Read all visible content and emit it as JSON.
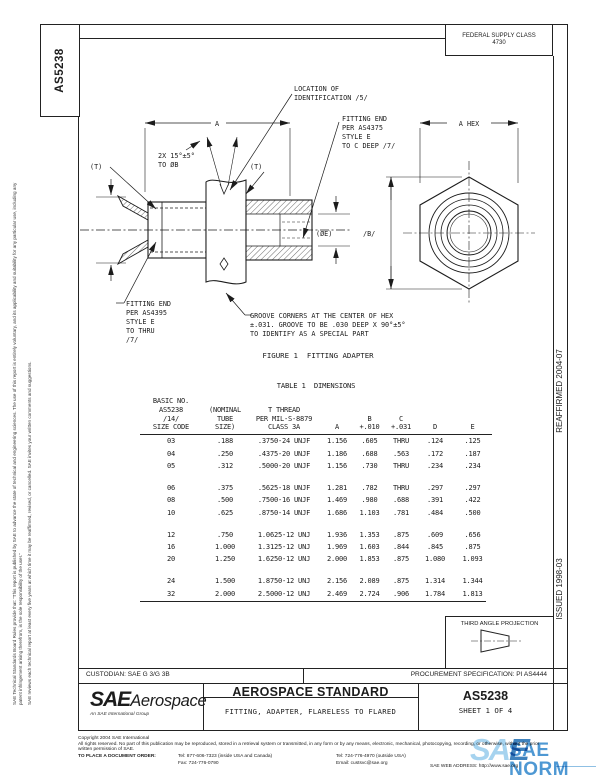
{
  "sheet": {
    "doc_number_side": "AS5238",
    "federal_supply_class": [
      "FEDERAL SUPPLY CLASS",
      "4730"
    ],
    "reaffirmed": "REAFFIRMED 2004-07",
    "issued": "ISSUED 1998-03",
    "disclaimer_1": "SAE Technical Standards Board Rules provide that: \"This report is published by SAE to advance the state of technical and engineering sciences. The use of this report is entirely voluntary, and its applicability and suitability for any particular use, including any patent infringement arising therefrom, is the sole responsibility of the user.\"",
    "disclaimer_2": "SAE reviews each technical report at least every five years at which time it may be reaffirmed, revised, or cancelled. SAE invites your written comments and suggestions."
  },
  "figure": {
    "caption": "FIGURE 1  FITTING ADAPTER",
    "location_note": [
      "LOCATION OF",
      "IDENTIFICATION /5/"
    ],
    "fitting_end_right": [
      "FITTING END",
      "PER AS4375",
      "STYLE E",
      "TO C DEEP /7/"
    ],
    "fitting_end_left": [
      "FITTING END",
      "PER AS4395",
      "STYLE E",
      "TO THRU",
      "/7/"
    ],
    "chamfer_note": [
      "2X 15°±5°",
      "TO ØB"
    ],
    "groove_note": [
      "GROOVE CORNERS AT THE CENTER OF HEX",
      "±.031. GROOVE TO BE .030 DEEP X 90°±5°",
      "TO IDENTIFY AS A SPECIAL PART"
    ],
    "dim_a": "A",
    "dim_a_hex": "A HEX",
    "dim_b": "/B/",
    "dim_t_left": "(T)",
    "dim_t_right": "(T)",
    "dia_d": "(ØD)",
    "dia_e": "(ØE)"
  },
  "table": {
    "title": "TABLE 1  DIMENSIONS",
    "header_columns": [
      [
        "BASIC NO.",
        "AS5238",
        "/14/",
        "SIZE CODE"
      ],
      [
        "(NOMINAL",
        "TUBE",
        "SIZE)"
      ],
      [
        "T THREAD",
        "PER MIL-S-8879",
        "CLASS 3A"
      ],
      [
        "A"
      ],
      [
        "B",
        "+.010"
      ],
      [
        "C",
        "+.031"
      ],
      [
        "D"
      ],
      [
        "E"
      ]
    ],
    "row_groups": [
      [
        [
          "03",
          ".188",
          ".3750-24 UNJF",
          "1.156",
          ".605",
          "THRU",
          ".124",
          ".125"
        ],
        [
          "04",
          ".250",
          ".4375-20 UNJF",
          "1.186",
          ".688",
          ".563",
          ".172",
          ".187"
        ],
        [
          "05",
          ".312",
          ".5000-20 UNJF",
          "1.156",
          ".730",
          "THRU",
          ".234",
          ".234"
        ]
      ],
      [
        [
          "06",
          ".375",
          ".5625-18 UNJF",
          "1.281",
          ".782",
          "THRU",
          ".297",
          ".297"
        ],
        [
          "08",
          ".500",
          ".7500-16 UNJF",
          "1.469",
          ".980",
          ".688",
          ".391",
          ".422"
        ],
        [
          "10",
          ".625",
          ".8750-14 UNJF",
          "1.686",
          "1.103",
          ".781",
          ".484",
          ".500"
        ]
      ],
      [
        [
          "12",
          ".750",
          "1.0625-12 UNJ",
          "1.936",
          "1.353",
          ".875",
          ".609",
          ".656"
        ],
        [
          "16",
          "1.000",
          "1.3125-12 UNJ",
          "1.969",
          "1.603",
          ".844",
          ".845",
          ".875"
        ],
        [
          "20",
          "1.250",
          "1.6250-12 UNJ",
          "2.000",
          "1.853",
          ".875",
          "1.080",
          "1.093"
        ]
      ],
      [
        [
          "24",
          "1.500",
          "1.8750-12 UNJ",
          "2.156",
          "2.089",
          ".875",
          "1.314",
          "1.344"
        ],
        [
          "32",
          "2.000",
          "2.5000-12 UNJ",
          "2.469",
          "2.724",
          ".906",
          "1.784",
          "1.813"
        ]
      ]
    ]
  },
  "projection": {
    "label": "THIRD ANGLE PROJECTION"
  },
  "title_block": {
    "custodian": "CUSTODIAN: SAE G 3/G 3B",
    "procurement": "PROCUREMENT SPECIFICATION: PI AS4444",
    "standard_type": "AEROSPACE STANDARD",
    "document_title": "FITTING, ADAPTER, FLARELESS TO FLARED",
    "document_number": "AS5238",
    "sheet": "SHEET 1 OF 4",
    "logo_sae": "SAE",
    "logo_aerospace": "Aerospace",
    "logo_subtitle": "An SAE International Group"
  },
  "footer": {
    "copyright": "Copyright 2004 SAE International",
    "rights": "All rights reserved. No part of this publication may be reproduced, stored in a retrieval system or transmitted, in any form or by any means, electronic, mechanical, photocopying, recording, or otherwise, without the prior written permission of SAE.",
    "order_label": "TO PLACE A DOCUMENT ORDER:",
    "tel_us": "Tel: 877-606-7323 (inside USA and Canada)",
    "tel_intl": "Tel: 724-776-4970 (outside USA)",
    "fax": "Fax: 724-776-0790",
    "email": "Email: custsvc@sae.org",
    "web": "SAE WEB ADDRESS: http://www.sae.org"
  },
  "watermark": {
    "sa": "SA",
    "e": "E",
    "norm": "SAE NORM"
  }
}
